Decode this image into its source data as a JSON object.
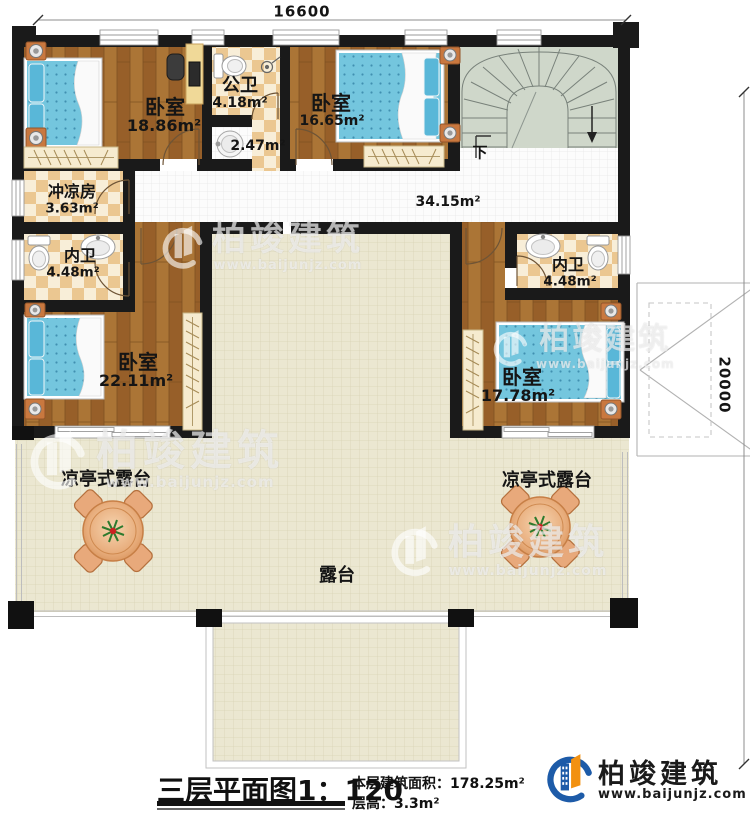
{
  "meta": {
    "plan_title": "三层平面图",
    "scale": "1：120",
    "building_area_label": "本层建筑面积：",
    "building_area_value": "178.25m²",
    "floor_height_label": "层高：",
    "floor_height_value": "3.3m²"
  },
  "dimensions": {
    "top": "16600",
    "right": "20000"
  },
  "stair": {
    "down_label": "下"
  },
  "rooms": {
    "bedroom_top_left": {
      "label": "卧室",
      "area": "18.86m²"
    },
    "public_bath": {
      "label": "公卫",
      "area": "4.18m²"
    },
    "wash_area": {
      "area": "2.47m²"
    },
    "bedroom_top_right": {
      "label": "卧室",
      "area": "16.65m²"
    },
    "shower_room": {
      "label": "冲凉房",
      "area": "3.63m²"
    },
    "ensuite_left": {
      "label": "内卫",
      "area": "4.48m²"
    },
    "ensuite_right": {
      "label": "内卫",
      "area": "4.48m²"
    },
    "bedroom_bottom_left": {
      "label": "卧室",
      "area": "22.11m²"
    },
    "bedroom_bottom_right": {
      "label": "卧室",
      "area": "17.78m²"
    },
    "hallway": {
      "area": "34.15m²"
    },
    "terrace": {
      "label": "露台"
    },
    "pavilion_left": {
      "label": "凉亭式露台"
    },
    "pavilion_right": {
      "label": "凉亭式露台"
    }
  },
  "branding": {
    "company": "柏竣建筑",
    "website": "www.baijunjz.com"
  },
  "watermark": {
    "company": "柏竣建筑",
    "website": "www.baijunjz.com"
  },
  "colors": {
    "wall": "#1a1a1a",
    "wood_floor": "#a26c2e",
    "bath_tile": "#ecc98f",
    "terrace": "#ebe7d1",
    "stair": "#cfd7ca",
    "bed_blue": "#74c6de",
    "logo_blue": "#1d5ba8",
    "logo_orange": "#f29111"
  }
}
